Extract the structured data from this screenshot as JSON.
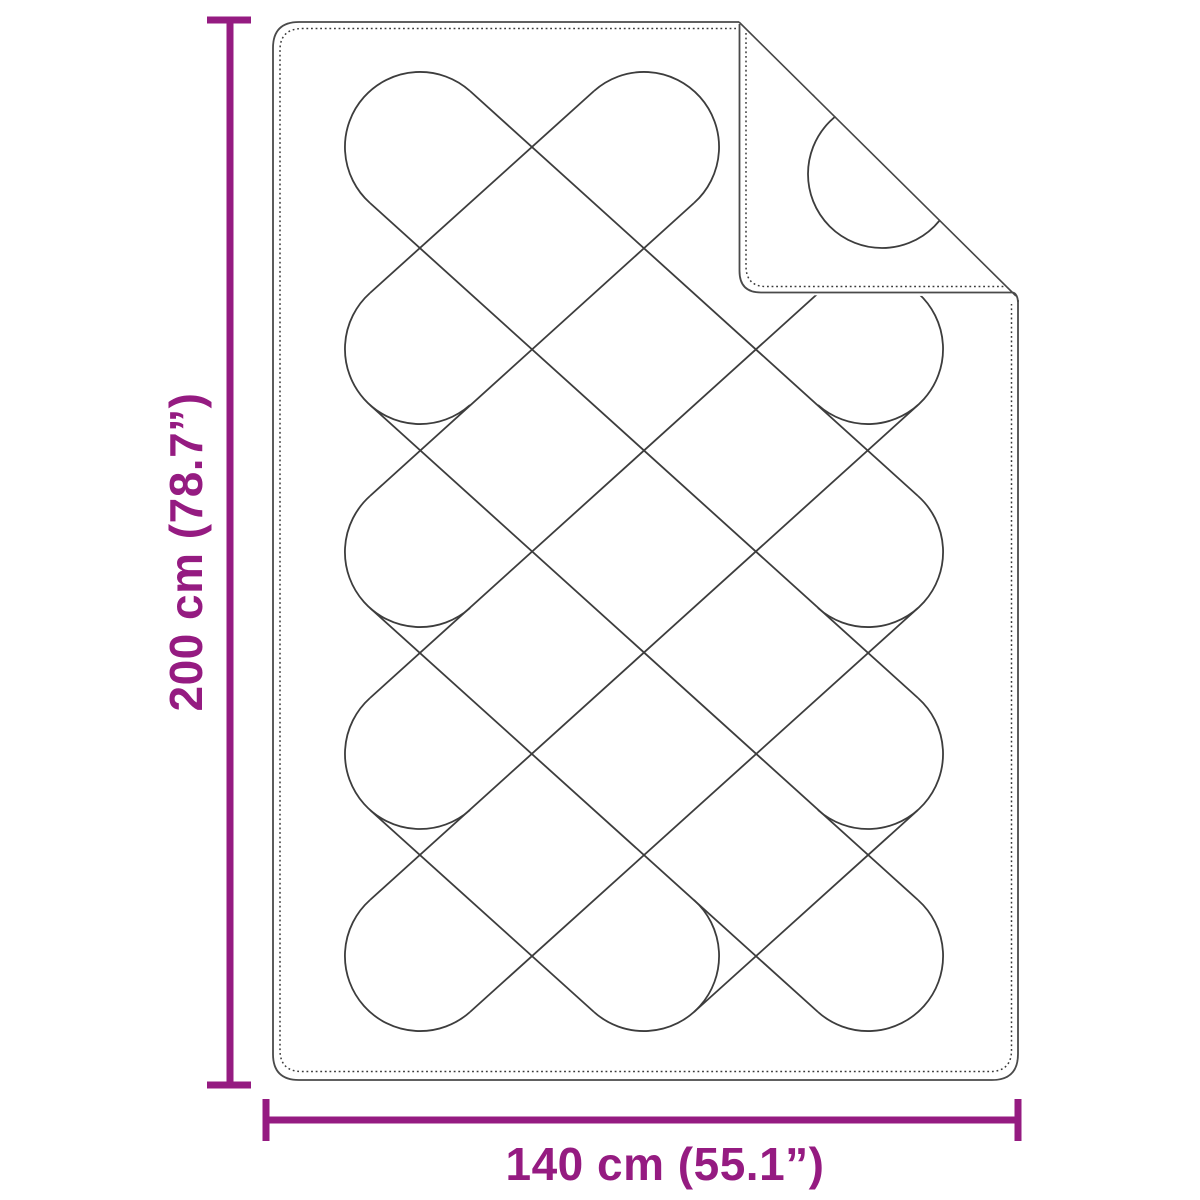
{
  "diagram": {
    "subject": "quilted-blanket-top-view-with-folded-corner",
    "height_dimension": {
      "label": "200 cm (78.7”)"
    },
    "width_dimension": {
      "label": "140 cm (55.1”)"
    },
    "colors": {
      "dimension_accent": "#951b81",
      "outline": "#4a4a4a",
      "quilting": "#3d3d3d",
      "background": "#ffffff"
    }
  }
}
